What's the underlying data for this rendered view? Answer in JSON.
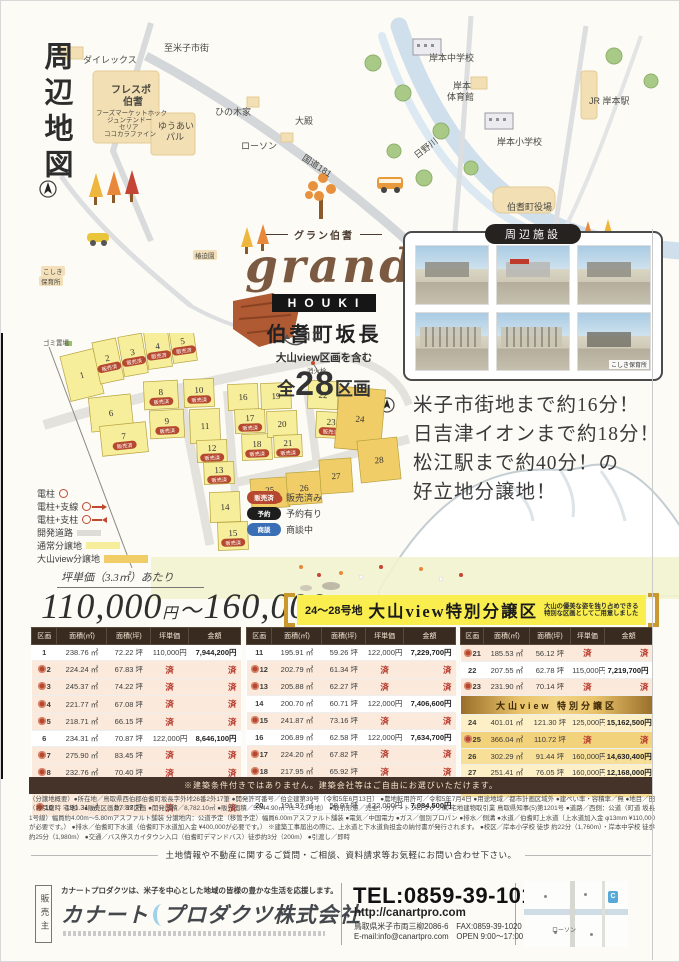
{
  "page": {
    "map_title": "周辺地図"
  },
  "map": {
    "labels": [
      {
        "t": "至米子市街",
        "x": 163,
        "y": 40,
        "c": "sm"
      },
      {
        "t": "ダイレックス",
        "x": 82,
        "y": 52,
        "c": "sm"
      },
      {
        "t": "フレスポ",
        "x": 110,
        "y": 80,
        "c": "md"
      },
      {
        "t": "伯耆",
        "x": 122,
        "y": 92,
        "c": "md"
      },
      {
        "t": "フーズマーケットホック",
        "x": 95,
        "y": 106,
        "c": "xs"
      },
      {
        "t": "ジュンテンドー",
        "x": 106,
        "y": 113,
        "c": "xs"
      },
      {
        "t": "セリア",
        "x": 118,
        "y": 120,
        "c": "xs"
      },
      {
        "t": "ココカラファイン",
        "x": 103,
        "y": 127,
        "c": "xs"
      },
      {
        "t": "ひの木家",
        "x": 214,
        "y": 104,
        "c": "sm"
      },
      {
        "t": "ゆうあい",
        "x": 157,
        "y": 118,
        "c": "sm"
      },
      {
        "t": "パル",
        "x": 165,
        "y": 129,
        "c": "sm"
      },
      {
        "t": "ローソン",
        "x": 240,
        "y": 138,
        "c": "sm"
      },
      {
        "t": "大殿",
        "x": 294,
        "y": 113,
        "c": "sm"
      },
      {
        "t": "国道181",
        "x": 306,
        "y": 150,
        "r": 33,
        "c": "sm"
      },
      {
        "t": "岸本中学校",
        "x": 428,
        "y": 50,
        "c": "sm"
      },
      {
        "t": "岸本",
        "x": 452,
        "y": 78,
        "c": "sm"
      },
      {
        "t": "体育館",
        "x": 446,
        "y": 89,
        "c": "sm"
      },
      {
        "t": "JR 岸本駅",
        "x": 588,
        "y": 93,
        "c": "sm"
      },
      {
        "t": "岸本小学校",
        "x": 496,
        "y": 134,
        "c": "sm"
      },
      {
        "t": "日野川",
        "x": 410,
        "y": 150,
        "r": -38,
        "c": "sm"
      },
      {
        "t": "伯耆町役場",
        "x": 506,
        "y": 199,
        "c": "sm"
      },
      {
        "t": "椿迫園",
        "x": 192,
        "y": 249,
        "c": "xs beige"
      },
      {
        "t": "こしき",
        "x": 40,
        "y": 265,
        "c": "xs beige"
      },
      {
        "t": "保育所",
        "x": 38,
        "y": 275,
        "c": "xs beige"
      },
      {
        "t": "ゴミ置場",
        "x": 42,
        "y": 336,
        "c": "xs"
      },
      {
        "t": "消火栓",
        "x": 306,
        "y": 364,
        "c": "xs"
      }
    ]
  },
  "logo": {
    "kana": "グラン伯耆",
    "script": "grand",
    "sub": "HOUKI",
    "location": "伯耆町坂長",
    "includes": "大山view区画を含む",
    "total_prefix": "全",
    "total_count": "28",
    "total_suffix": "区画",
    "here": "ココ"
  },
  "facilities": {
    "title": "周辺施設",
    "photos": [
      {},
      {},
      {},
      {},
      {},
      {
        "caption": "こしき保育所"
      }
    ]
  },
  "catchphrase": {
    "lines": [
      "米子市街地まで約16分！",
      "日吉津イオンまで約18分！",
      "松江駅まで約40分！の",
      "好立地分譲地！"
    ]
  },
  "site": {
    "sold_badge": "販売済",
    "lots": [
      {
        "n": "1",
        "cx": 55,
        "cy": 42,
        "w": 34,
        "h": 46,
        "r": -14,
        "sold": false
      },
      {
        "n": "2",
        "cx": 81,
        "cy": 28,
        "w": 24,
        "h": 42,
        "r": -12,
        "sold": true
      },
      {
        "n": "3",
        "cx": 106,
        "cy": 22,
        "w": 24,
        "h": 40,
        "r": -10,
        "sold": true
      },
      {
        "n": "4",
        "cx": 131,
        "cy": 16,
        "w": 24,
        "h": 38,
        "r": -8,
        "sold": true
      },
      {
        "n": "5",
        "cx": 156,
        "cy": 11,
        "w": 24,
        "h": 36,
        "r": -8,
        "sold": true
      },
      {
        "n": "6",
        "cx": 84,
        "cy": 80,
        "w": 42,
        "h": 34,
        "r": -6,
        "sold": false
      },
      {
        "n": "7",
        "cx": 97,
        "cy": 106,
        "w": 46,
        "h": 30,
        "r": -6,
        "sold": true
      },
      {
        "n": "8",
        "cx": 134,
        "cy": 62,
        "w": 34,
        "h": 28,
        "r": -3,
        "sold": true
      },
      {
        "n": "9",
        "cx": 140,
        "cy": 91,
        "w": 34,
        "h": 28,
        "r": -3,
        "sold": true
      },
      {
        "n": "10",
        "cx": 172,
        "cy": 60,
        "w": 30,
        "h": 28,
        "r": -2,
        "sold": true
      },
      {
        "n": "11",
        "cx": 178,
        "cy": 93,
        "w": 30,
        "h": 34,
        "r": -2,
        "sold": false
      },
      {
        "n": "12",
        "cx": 185,
        "cy": 118,
        "w": 30,
        "h": 22,
        "r": -2,
        "sold": true
      },
      {
        "n": "13",
        "cx": 192,
        "cy": 140,
        "w": 30,
        "h": 22,
        "r": -2,
        "sold": true
      },
      {
        "n": "14",
        "cx": 198,
        "cy": 174,
        "w": 30,
        "h": 30,
        "r": -2,
        "sold": false
      },
      {
        "n": "15",
        "cx": 206,
        "cy": 203,
        "w": 30,
        "h": 28,
        "r": -2,
        "sold": true
      },
      {
        "n": "16",
        "cx": 216,
        "cy": 64,
        "w": 30,
        "h": 26,
        "r": -2,
        "sold": false
      },
      {
        "n": "17",
        "cx": 223,
        "cy": 88,
        "w": 30,
        "h": 24,
        "r": -2,
        "sold": true
      },
      {
        "n": "18",
        "cx": 230,
        "cy": 114,
        "w": 30,
        "h": 26,
        "r": -2,
        "sold": true
      },
      {
        "n": "19",
        "cx": 249,
        "cy": 63,
        "w": 30,
        "h": 26,
        "r": -2,
        "sold": false
      },
      {
        "n": "20",
        "cx": 255,
        "cy": 91,
        "w": 30,
        "h": 26,
        "r": -2,
        "sold": false
      },
      {
        "n": "21",
        "cx": 261,
        "cy": 113,
        "w": 28,
        "h": 22,
        "r": -2,
        "sold": true
      },
      {
        "n": "22",
        "cx": 296,
        "cy": 62,
        "w": 30,
        "h": 28,
        "r": 3,
        "sold": false
      },
      {
        "n": "23",
        "cx": 304,
        "cy": 92,
        "w": 30,
        "h": 26,
        "r": 3,
        "sold": true
      },
      {
        "n": "24",
        "cx": 333,
        "cy": 86,
        "w": 46,
        "h": 62,
        "r": 5,
        "sold": false,
        "view": true
      },
      {
        "n": "25",
        "cx": 243,
        "cy": 160,
        "w": 38,
        "h": 30,
        "r": -4,
        "sold": true,
        "view": true
      },
      {
        "n": "26",
        "cx": 277,
        "cy": 155,
        "w": 34,
        "h": 32,
        "r": -4,
        "sold": false,
        "view": true
      },
      {
        "n": "27",
        "cx": 309,
        "cy": 143,
        "w": 32,
        "h": 34,
        "r": -4,
        "sold": false,
        "view": true
      },
      {
        "n": "28",
        "cx": 352,
        "cy": 127,
        "w": 40,
        "h": 42,
        "r": -6,
        "sold": false,
        "view": true
      }
    ]
  },
  "legend": {
    "symbols": [
      {
        "t": "電柱",
        "k": "pole"
      },
      {
        "t": "電柱+支線",
        "k": "pole-arrow"
      },
      {
        "t": "電柱+支柱",
        "k": "pole-strut"
      },
      {
        "t": "開発道路",
        "k": "road"
      },
      {
        "t": "通常分譲地",
        "k": "normal"
      },
      {
        "t": "大山view分譲地",
        "k": "view"
      }
    ],
    "badges": [
      {
        "b": "販売済",
        "t": "販売済み",
        "k": "sold"
      },
      {
        "b": "予約",
        "t": "予約有り",
        "k": "reserve"
      },
      {
        "b": "商談",
        "t": "商談中",
        "k": "talk"
      }
    ]
  },
  "pricing": {
    "unit_note": "坪単価（3.3㎡）あたり",
    "from": "110,000",
    "to": "160,000",
    "yen": "円",
    "tilde": "〜"
  },
  "special": {
    "lots_range": "24〜28号地",
    "title": "大山view特別分譲区",
    "note1": "大山の優美な姿を独り占めできる",
    "note2": "特別な区画としてご用意しました"
  },
  "tables": {
    "headers": [
      "区画",
      "面積(㎡)",
      "面積(坪)",
      "坪単価",
      "金額"
    ],
    "sold_mark": "済",
    "view_subheader": "大山view 特別分譲区",
    "groups": [
      [
        {
          "lot": "1",
          "m2": "238.76 ㎡",
          "tsubo": "72.22 坪",
          "price": "110,000円",
          "total": "7,944,200円",
          "sold": false
        },
        {
          "lot": "2",
          "m2": "224.24 ㎡",
          "tsubo": "67.83 坪",
          "sold": true
        },
        {
          "lot": "3",
          "m2": "245.37 ㎡",
          "tsubo": "74.22 坪",
          "sold": true
        },
        {
          "lot": "4",
          "m2": "221.77 ㎡",
          "tsubo": "67.08 坪",
          "sold": true
        },
        {
          "lot": "5",
          "m2": "218.71 ㎡",
          "tsubo": "66.15 坪",
          "sold": true
        },
        {
          "lot": "6",
          "m2": "234.31 ㎡",
          "tsubo": "70.87 坪",
          "price": "122,000円",
          "total": "8,646,100円",
          "sold": false
        },
        {
          "lot": "7",
          "m2": "275.90 ㎡",
          "tsubo": "83.45 坪",
          "sold": true
        },
        {
          "lot": "8",
          "m2": "232.76 ㎡",
          "tsubo": "70.40 坪",
          "sold": true
        },
        {
          "lot": "9",
          "m2": "259.35 ㎡",
          "tsubo": "78.45 坪",
          "sold": true
        },
        {
          "lot": "10",
          "m2": "191.31 ㎡",
          "tsubo": "57.87 坪",
          "sold": true
        }
      ],
      [
        {
          "lot": "11",
          "m2": "195.91 ㎡",
          "tsubo": "59.26 坪",
          "price": "122,000円",
          "total": "7,229,700円",
          "sold": false
        },
        {
          "lot": "12",
          "m2": "202.79 ㎡",
          "tsubo": "61.34 坪",
          "sold": true
        },
        {
          "lot": "13",
          "m2": "205.88 ㎡",
          "tsubo": "62.27 坪",
          "sold": true
        },
        {
          "lot": "14",
          "m2": "200.70 ㎡",
          "tsubo": "60.71 坪",
          "price": "122,000円",
          "total": "7,406,600円",
          "sold": false
        },
        {
          "lot": "15",
          "m2": "241.87 ㎡",
          "tsubo": "73.16 坪",
          "sold": true
        },
        {
          "lot": "16",
          "m2": "206.89 ㎡",
          "tsubo": "62.58 坪",
          "price": "122,000円",
          "total": "7,634,700円",
          "sold": false
        },
        {
          "lot": "17",
          "m2": "224.20 ㎡",
          "tsubo": "67.82 坪",
          "sold": true
        },
        {
          "lot": "18",
          "m2": "217.95 ㎡",
          "tsubo": "65.92 坪",
          "sold": true
        },
        {
          "lot": "19",
          "m2": "189.50 ㎡",
          "tsubo": "57.32 坪",
          "price": "122,000円",
          "total": "6,993,000円",
          "sold": false
        },
        {
          "lot": "20",
          "m2": "191.97 ㎡",
          "tsubo": "58.07 坪",
          "price": "122,000円",
          "total": "7,084,500円",
          "sold": false
        }
      ],
      [
        {
          "lot": "21",
          "m2": "185.53 ㎡",
          "tsubo": "56.12 坪",
          "sold": true
        },
        {
          "lot": "22",
          "m2": "207.55 ㎡",
          "tsubo": "62.78 坪",
          "price": "115,000円",
          "total": "7,219,700円",
          "sold": false
        },
        {
          "lot": "23",
          "m2": "231.90 ㎡",
          "tsubo": "70.14 坪",
          "sold": true
        },
        {
          "sub": true
        },
        {
          "lot": "24",
          "m2": "401.01 ㎡",
          "tsubo": "121.30 坪",
          "price": "125,000円",
          "total": "15,162,500円",
          "sold": false,
          "view": true
        },
        {
          "lot": "25",
          "m2": "366.04 ㎡",
          "tsubo": "110.72 坪",
          "sold": true,
          "view": true
        },
        {
          "lot": "26",
          "m2": "302.29 ㎡",
          "tsubo": "91.44 坪",
          "price": "160,000円",
          "total": "14,630,400円",
          "sold": false,
          "view": true,
          "alt": true
        },
        {
          "lot": "27",
          "m2": "251.41 ㎡",
          "tsubo": "76.05 坪",
          "price": "160,000円",
          "total": "12,168,000円",
          "sold": false,
          "view": true
        },
        {
          "lot": "28",
          "m2": "300.18 ㎡",
          "tsubo": "90.80 坪",
          "price": "160,000円",
          "total": "14,528,000円",
          "sold": false,
          "view": true,
          "alt": true
        }
      ]
    ]
  },
  "notice": "※建築条件付きではありません。建築会社等はご自由にお選びいただけます。",
  "fine_print": "（分譲地概要）●所在地／鳥取県西伯郡伯耆町坂長字外垰26番2外17筆 ●開発許可番号／伯企建第39号（令和5年6月13日） ●農地転用許可／令和5年7月4日 ●用途地域／都市計画区域外 ●建ぺい率・容積率／無 ●地目／田（お引渡時 宅地） ●販売区画数／28区画 ●開発面積／8,782.10㎡ ●販売面積／5,044.90㎡（1〜23号地） ●取引形態／売主：カナートプロダクツ㈱ 宅地建物取引業 鳥取県知事(5)第1201号 ●道路／西側：公道（町道 坂長1号線）幅員約4.00m〜5.80mアスファルト舗装 分譲地内：公道予定（移管予定）幅員6.00mアスファルト舗装 ●電気／中国電力 ●ガス／個別プロパン ●排水／側溝 ●水道／伯耆町上水道（上水道加入金 φ13mm ¥110,000が必要です。） ●排水／伯耆町下水道（伯耆町下水道加入金 ¥400,000が必要です。） ※建築工事届出の際に、上水道と下水道負担金の納付書が発行されます。 ●校区／岸本小学校 徒歩 約22分（1,760m）・岸本中学校 徒歩 約25分（1,980m） ●交通／バス停スカイタウン入口（伯耆町デマンドバス）徒歩約3分（200m） ●引渡し／即時",
  "contact": {
    "inquiry": "土地情報や不動産に関するご質問・ご相談、資料請求等お気軽にお問い合わせ下さい。",
    "seller_label": "販売主",
    "tagline": "カナートプロダクツは、米子を中心とした地域の皆様の豊かな生活を応援します。",
    "company_1": "カナート",
    "company_2": "プロダクツ株式会社",
    "tel": "TEL:0859-39-1010",
    "url": "http://canartpro.com",
    "address": "鳥取県米子市両三柳2086-6　FAX:0859-39-1020",
    "email_open": "E-mail:info@canartpro.com　OPEN 9:00〜17:00　定休日:日・祝",
    "map_label": "ローソン",
    "map_pin": "C"
  }
}
